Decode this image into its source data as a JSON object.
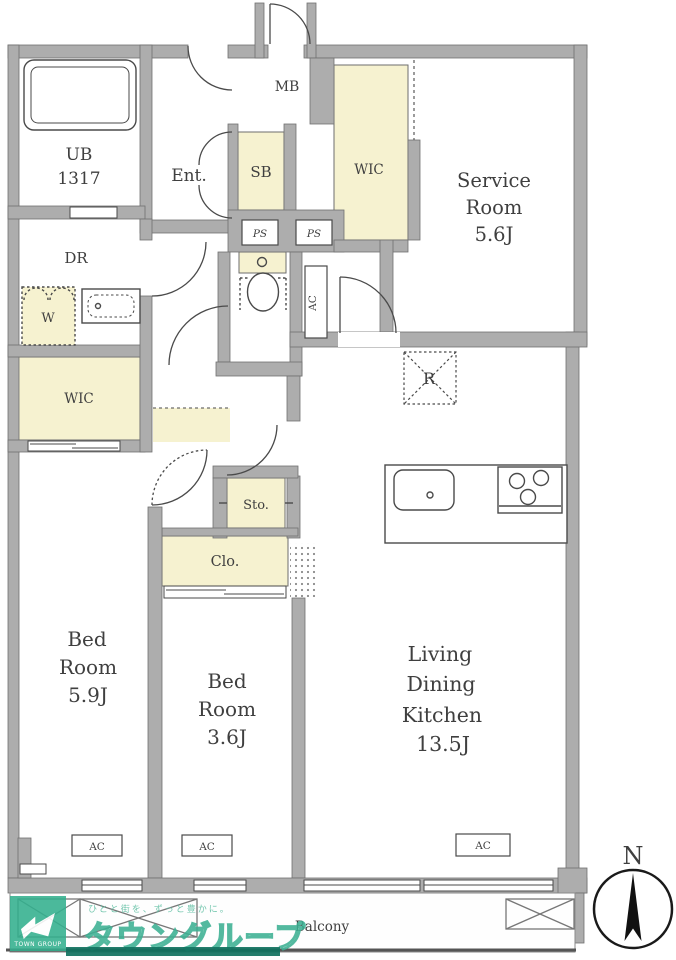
{
  "floorplan": {
    "ub": {
      "name": "UB",
      "size": "1317"
    },
    "entrance": {
      "label": "Ent."
    },
    "meter_box": {
      "label": "MB"
    },
    "shoe_box": {
      "label": "SB"
    },
    "wic_upper": {
      "label": "WIC"
    },
    "service_room": {
      "line1": "Service",
      "line2": "Room",
      "size": "5.6J"
    },
    "pipe_space1": {
      "label": "PS"
    },
    "pipe_space2": {
      "label": "PS"
    },
    "ac_service": {
      "label": "AC"
    },
    "dressing_room": {
      "label": "DR"
    },
    "washer": {
      "label": "W"
    },
    "wic_left": {
      "label": "WIC"
    },
    "refrigerator": {
      "label": "R"
    },
    "storage": {
      "label": "Sto."
    },
    "closet": {
      "label": "Clo."
    },
    "bedroom1": {
      "line1": "Bed",
      "line2": "Room",
      "size": "5.9J",
      "ac": "AC"
    },
    "bedroom2": {
      "line1": "Bed",
      "line2": "Room",
      "size": "3.6J",
      "ac": "AC"
    },
    "ldk": {
      "line1": "Living",
      "line2": "Dining",
      "line3": "Kitchen",
      "size": "13.5J",
      "ac": "AC"
    },
    "balcony": {
      "label": "Balcony"
    },
    "compass": {
      "label": "N"
    }
  },
  "watermark": {
    "tagline": "ひとと街を、ずっと豊かに。",
    "brand": "タウングループ",
    "logo_text": "TOWN GROUP"
  },
  "colors": {
    "wall": "#adadad",
    "closet_fill": "#f6f2d0",
    "brand_green": "#33b08e"
  }
}
